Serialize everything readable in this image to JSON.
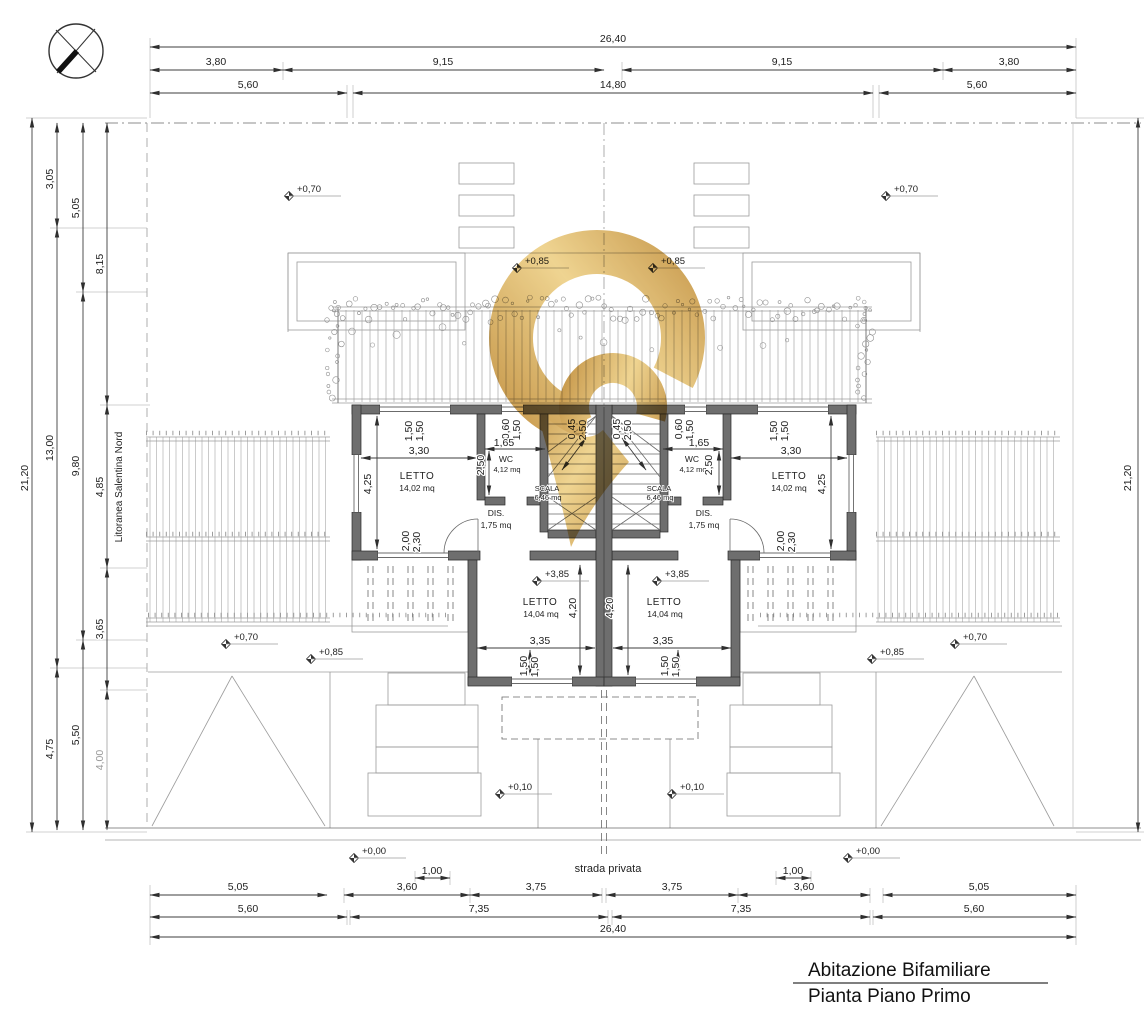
{
  "labels": {
    "title1": "Abitazione Bifamiliare",
    "title2": "Pianta Piano Primo",
    "strada": "strada privata",
    "road": "Litoranea Salentina Nord"
  },
  "dims": {
    "total_w": "26,40",
    "total_h": "21,20",
    "top2": [
      "3,80",
      "9,15",
      "9,15",
      "3,80"
    ],
    "top3": [
      "5,60",
      "14,80",
      "5,60"
    ],
    "left2": [
      "3,05",
      "13,00",
      "4,75"
    ],
    "left3": [
      "5,05",
      "9,80",
      "5,50"
    ],
    "left4": [
      "8,15",
      "4,85",
      "3,65",
      "4,00"
    ],
    "bottom1": [
      "5,05",
      "3,60",
      "3,75",
      "3,75",
      "3,60",
      "5,05"
    ],
    "small": "1,00",
    "bottom2": [
      "5,60",
      "7,35",
      "7,35",
      "5,60"
    ]
  },
  "rooms": {
    "letto": {
      "label": "LETTO",
      "area": "14,02 mq"
    },
    "letto_front": {
      "label": "LETTO",
      "area": "14,04 mq"
    },
    "wc": {
      "label": "WC",
      "area": "4,12 mq"
    },
    "dis": {
      "label": "DIS.",
      "area": "1,75 mq"
    },
    "scala": {
      "label": "SCALA",
      "area": "6,46 mq"
    }
  },
  "plan": {
    "d150": "1,50",
    "d330": "3,30",
    "d425": "4,25",
    "d200": "2,00",
    "d230": "2,30",
    "d060": "0,60",
    "d165": "1,65",
    "d250": "2,50",
    "d045": "0,45",
    "d420": "4,20",
    "d335": "3,35"
  },
  "elev": {
    "e000": "+0,00",
    "e010": "+0,10",
    "e070": "+0,70",
    "e085": "+0,85",
    "e385": "+3,85"
  },
  "colors": {
    "wall_gray": "#6e6e6e",
    "line_dark": "#3d3d3d",
    "watermark_gold": "#d8a84e"
  }
}
